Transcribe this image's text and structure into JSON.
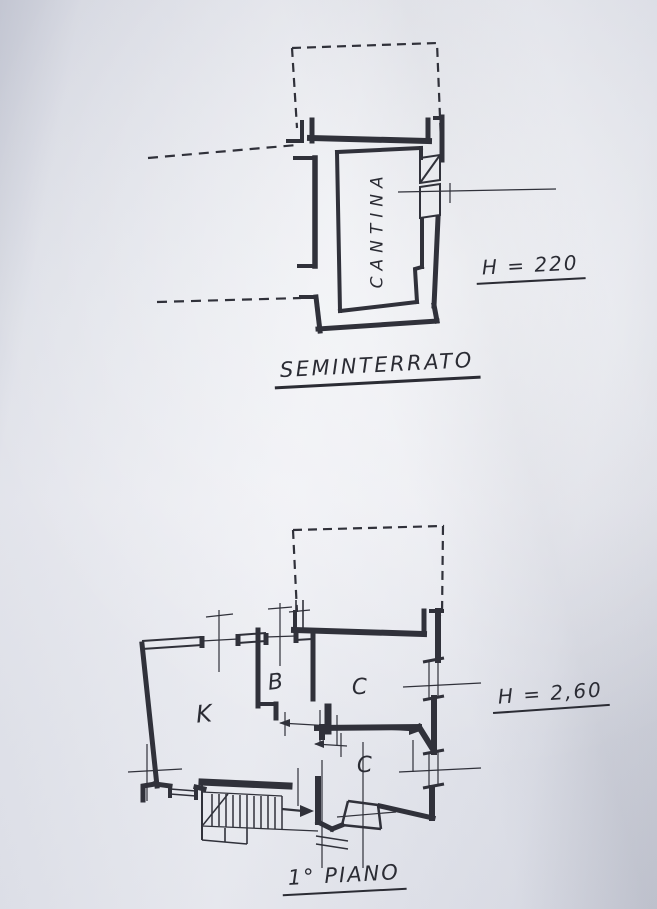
{
  "colors": {
    "ink": "#30313a",
    "paper": "#e3e5ec"
  },
  "plans": {
    "seminterrato": {
      "title": "SEMINTERRATO",
      "height_label": "H = 220",
      "rooms": [
        {
          "label": "CANTINA"
        }
      ]
    },
    "primo_piano": {
      "title": "1° PIANO",
      "height_label": "H = 2,60",
      "rooms": [
        {
          "label": "K"
        },
        {
          "label": "B"
        },
        {
          "label": "C"
        },
        {
          "label": "C"
        }
      ]
    }
  }
}
